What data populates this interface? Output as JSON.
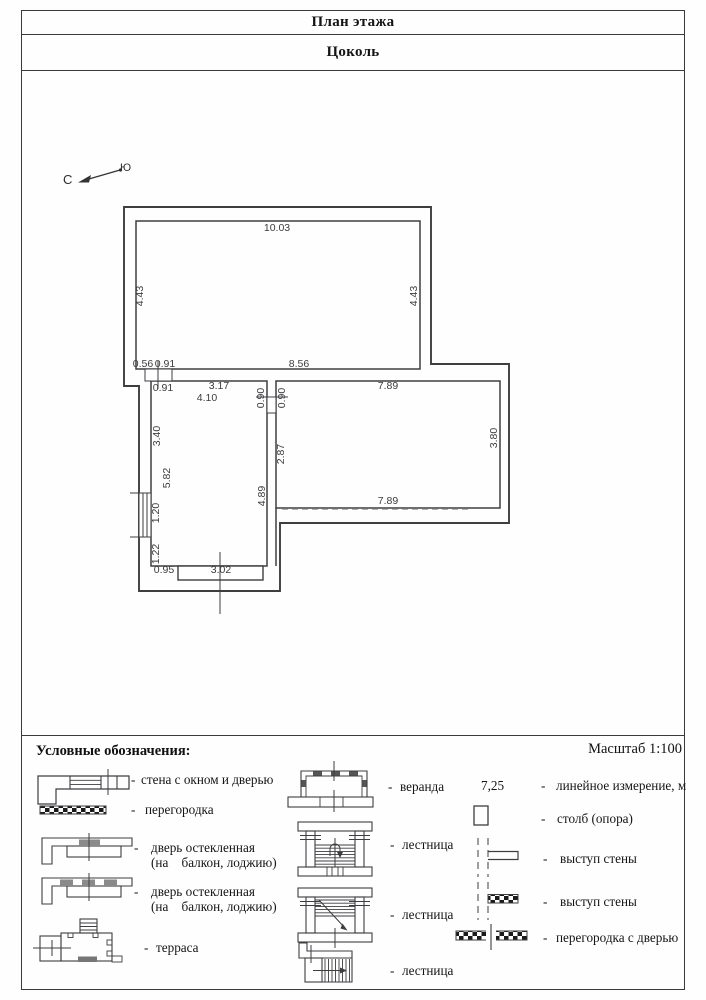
{
  "header": {
    "title": "План этажа",
    "subtitle": "Цоколь"
  },
  "compass": {
    "north": "С",
    "south": "Ю"
  },
  "plan": {
    "dims": {
      "top_width": "10.03",
      "room1_left": "4.43",
      "room1_right": "4.43",
      "off_left": "0.56",
      "door_top": "0.91",
      "wall_bottom": "8.56",
      "door_top2": "0.91",
      "seg_317": "3.17",
      "room2_width": "4.10",
      "part_door_l": "0.90",
      "part_door_r": "0.90",
      "room3_top": "7.89",
      "seg_340": "3.40",
      "room2_height": "5.82",
      "seg_287": "2.87",
      "seg_489": "4.89",
      "room3_right": "3.80",
      "room3_bottom": "7.89",
      "window": "1.20",
      "seg_122": "1.22",
      "off_bottom": "0.95",
      "porch_width": "3.02"
    }
  },
  "legend": {
    "title": "Условные обозначения:",
    "scale": "Масштаб 1:100",
    "dash": "-",
    "col1": [
      {
        "label": "стена с окном и дверью"
      },
      {
        "label": "перегородка"
      },
      {
        "label": "дверь остекленная",
        "label2": "(на    балкон, лоджию)"
      },
      {
        "label": "дверь остекленная",
        "label2": "(на    балкон, лоджию)"
      },
      {
        "label": "терраса"
      }
    ],
    "col2": [
      {
        "label": "веранда"
      },
      {
        "label": "лестница"
      },
      {
        "label": "лестница"
      },
      {
        "label": "лестница"
      }
    ],
    "col3": [
      {
        "value": "7,25",
        "label": "линейное измерение, м"
      },
      {
        "label": "столб (опора)"
      },
      {
        "label": "выступ стены"
      },
      {
        "label": "выступ стены"
      },
      {
        "label": "перегородка с дверью"
      }
    ]
  }
}
